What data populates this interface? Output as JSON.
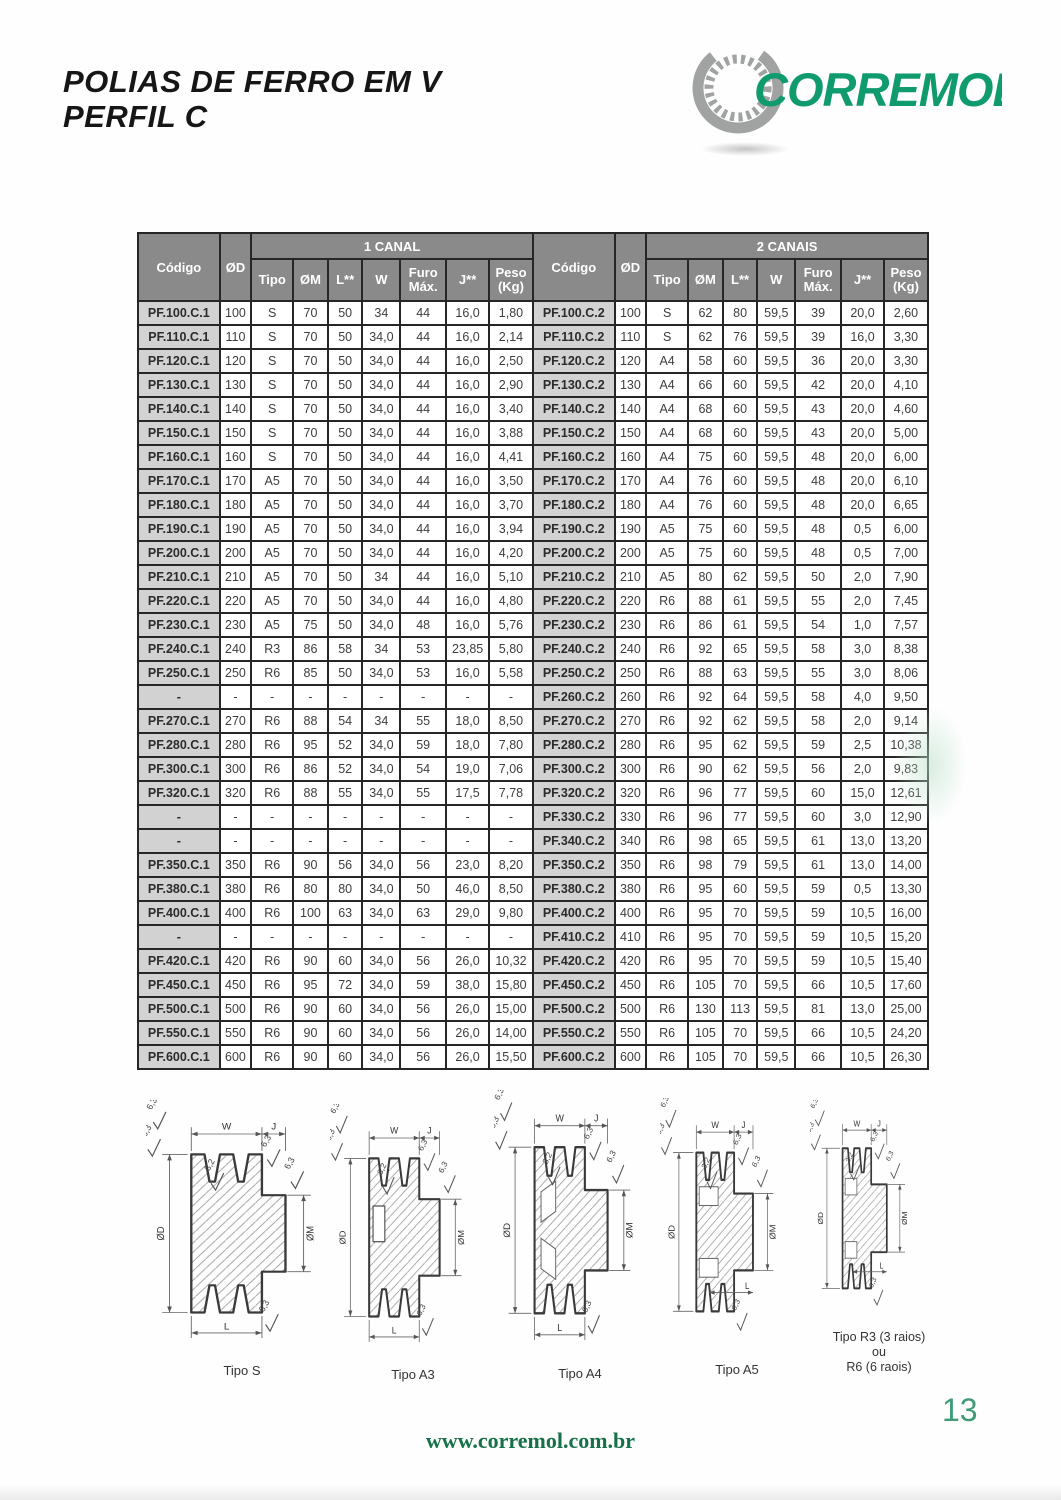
{
  "page": {
    "title_line1": "POLIAS DE FERRO EM V",
    "title_line2": "PERFIL C",
    "footer_url": "www.corremol.com.br",
    "page_number": "13"
  },
  "logo": {
    "text": "CORREMOL",
    "green": "#0f9b6d",
    "gear_gray": "#a0a3a2"
  },
  "table": {
    "header": {
      "codigo": "Código",
      "od": "ØD",
      "group1": "1 CANAL",
      "group2": "2 CANAIS",
      "sub": {
        "tipo": "Tipo",
        "om": "ØM",
        "l": "L**",
        "w": "W",
        "furo1": "Furo",
        "furo2": "Máx.",
        "j": "J**",
        "peso1": "Peso",
        "peso2": "(Kg)"
      }
    },
    "rows": [
      [
        "PF.100.C.1",
        "100",
        "S",
        "70",
        "50",
        "34",
        "44",
        "16,0",
        "1,80",
        "PF.100.C.2",
        "100",
        "S",
        "62",
        "80",
        "59,5",
        "39",
        "20,0",
        "2,60"
      ],
      [
        "PF.110.C.1",
        "110",
        "S",
        "70",
        "50",
        "34,0",
        "44",
        "16,0",
        "2,14",
        "PF.110.C.2",
        "110",
        "S",
        "62",
        "76",
        "59,5",
        "39",
        "16,0",
        "3,30"
      ],
      [
        "PF.120.C.1",
        "120",
        "S",
        "70",
        "50",
        "34,0",
        "44",
        "16,0",
        "2,50",
        "PF.120.C.2",
        "120",
        "A4",
        "58",
        "60",
        "59,5",
        "36",
        "20,0",
        "3,30"
      ],
      [
        "PF.130.C.1",
        "130",
        "S",
        "70",
        "50",
        "34,0",
        "44",
        "16,0",
        "2,90",
        "PF.130.C.2",
        "130",
        "A4",
        "66",
        "60",
        "59,5",
        "42",
        "20,0",
        "4,10"
      ],
      [
        "PF.140.C.1",
        "140",
        "S",
        "70",
        "50",
        "34,0",
        "44",
        "16,0",
        "3,40",
        "PF.140.C.2",
        "140",
        "A4",
        "68",
        "60",
        "59,5",
        "43",
        "20,0",
        "4,60"
      ],
      [
        "PF.150.C.1",
        "150",
        "S",
        "70",
        "50",
        "34,0",
        "44",
        "16,0",
        "3,88",
        "PF.150.C.2",
        "150",
        "A4",
        "68",
        "60",
        "59,5",
        "43",
        "20,0",
        "5,00"
      ],
      [
        "PF.160.C.1",
        "160",
        "S",
        "70",
        "50",
        "34,0",
        "44",
        "16,0",
        "4,41",
        "PF.160.C.2",
        "160",
        "A4",
        "75",
        "60",
        "59,5",
        "48",
        "20,0",
        "6,00"
      ],
      [
        "PF.170.C.1",
        "170",
        "A5",
        "70",
        "50",
        "34,0",
        "44",
        "16,0",
        "3,50",
        "PF.170.C.2",
        "170",
        "A4",
        "76",
        "60",
        "59,5",
        "48",
        "20,0",
        "6,10"
      ],
      [
        "PF.180.C.1",
        "180",
        "A5",
        "70",
        "50",
        "34,0",
        "44",
        "16,0",
        "3,70",
        "PF.180.C.2",
        "180",
        "A4",
        "76",
        "60",
        "59,5",
        "48",
        "20,0",
        "6,65"
      ],
      [
        "PF.190.C.1",
        "190",
        "A5",
        "70",
        "50",
        "34,0",
        "44",
        "16,0",
        "3,94",
        "PF.190.C.2",
        "190",
        "A5",
        "75",
        "60",
        "59,5",
        "48",
        "0,5",
        "6,00"
      ],
      [
        "PF.200.C.1",
        "200",
        "A5",
        "70",
        "50",
        "34,0",
        "44",
        "16,0",
        "4,20",
        "PF.200.C.2",
        "200",
        "A5",
        "75",
        "60",
        "59,5",
        "48",
        "0,5",
        "7,00"
      ],
      [
        "PF.210.C.1",
        "210",
        "A5",
        "70",
        "50",
        "34",
        "44",
        "16,0",
        "5,10",
        "PF.210.C.2",
        "210",
        "A5",
        "80",
        "62",
        "59,5",
        "50",
        "2,0",
        "7,90"
      ],
      [
        "PF.220.C.1",
        "220",
        "A5",
        "70",
        "50",
        "34,0",
        "44",
        "16,0",
        "4,80",
        "PF.220.C.2",
        "220",
        "R6",
        "88",
        "61",
        "59,5",
        "55",
        "2,0",
        "7,45"
      ],
      [
        "PF.230.C.1",
        "230",
        "A5",
        "75",
        "50",
        "34,0",
        "48",
        "16,0",
        "5,76",
        "PF.230.C.2",
        "230",
        "R6",
        "86",
        "61",
        "59,5",
        "54",
        "1,0",
        "7,57"
      ],
      [
        "PF.240.C.1",
        "240",
        "R3",
        "86",
        "58",
        "34",
        "53",
        "23,85",
        "5,80",
        "PF.240.C.2",
        "240",
        "R6",
        "92",
        "65",
        "59,5",
        "58",
        "3,0",
        "8,38"
      ],
      [
        "PF.250.C.1",
        "250",
        "R6",
        "85",
        "50",
        "34,0",
        "53",
        "16,0",
        "5,58",
        "PF.250.C.2",
        "250",
        "R6",
        "88",
        "63",
        "59,5",
        "55",
        "3,0",
        "8,06"
      ],
      [
        "-",
        "-",
        "-",
        "-",
        "-",
        "-",
        "-",
        "-",
        "-",
        "PF.260.C.2",
        "260",
        "R6",
        "92",
        "64",
        "59,5",
        "58",
        "4,0",
        "9,50"
      ],
      [
        "PF.270.C.1",
        "270",
        "R6",
        "88",
        "54",
        "34",
        "55",
        "18,0",
        "8,50",
        "PF.270.C.2",
        "270",
        "R6",
        "92",
        "62",
        "59,5",
        "58",
        "2,0",
        "9,14"
      ],
      [
        "PF.280.C.1",
        "280",
        "R6",
        "95",
        "52",
        "34,0",
        "59",
        "18,0",
        "7,80",
        "PF.280.C.2",
        "280",
        "R6",
        "95",
        "62",
        "59,5",
        "59",
        "2,5",
        "10,38"
      ],
      [
        "PF.300.C.1",
        "300",
        "R6",
        "86",
        "52",
        "34,0",
        "54",
        "19,0",
        "7,06",
        "PF.300.C.2",
        "300",
        "R6",
        "90",
        "62",
        "59,5",
        "56",
        "2,0",
        "9,83"
      ],
      [
        "PF.320.C.1",
        "320",
        "R6",
        "88",
        "55",
        "34,0",
        "55",
        "17,5",
        "7,78",
        "PF.320.C.2",
        "320",
        "R6",
        "96",
        "77",
        "59,5",
        "60",
        "15,0",
        "12,61"
      ],
      [
        "-",
        "-",
        "-",
        "-",
        "-",
        "-",
        "-",
        "-",
        "-",
        "PF.330.C.2",
        "330",
        "R6",
        "96",
        "77",
        "59,5",
        "60",
        "3,0",
        "12,90"
      ],
      [
        "-",
        "-",
        "-",
        "-",
        "-",
        "-",
        "-",
        "-",
        "-",
        "PF.340.C.2",
        "340",
        "R6",
        "98",
        "65",
        "59,5",
        "61",
        "13,0",
        "13,20"
      ],
      [
        "PF.350.C.1",
        "350",
        "R6",
        "90",
        "56",
        "34,0",
        "56",
        "23,0",
        "8,20",
        "PF.350.C.2",
        "350",
        "R6",
        "98",
        "79",
        "59,5",
        "61",
        "13,0",
        "14,00"
      ],
      [
        "PF.380.C.1",
        "380",
        "R6",
        "80",
        "80",
        "34,0",
        "50",
        "46,0",
        "8,50",
        "PF.380.C.2",
        "380",
        "R6",
        "95",
        "60",
        "59,5",
        "59",
        "0,5",
        "13,30"
      ],
      [
        "PF.400.C.1",
        "400",
        "R6",
        "100",
        "63",
        "34,0",
        "63",
        "29,0",
        "9,80",
        "PF.400.C.2",
        "400",
        "R6",
        "95",
        "70",
        "59,5",
        "59",
        "10,5",
        "16,00"
      ],
      [
        "-",
        "-",
        "-",
        "-",
        "-",
        "-",
        "-",
        "-",
        "-",
        "PF.410.C.2",
        "410",
        "R6",
        "95",
        "70",
        "59,5",
        "59",
        "10,5",
        "15,20"
      ],
      [
        "PF.420.C.1",
        "420",
        "R6",
        "90",
        "60",
        "34,0",
        "56",
        "26,0",
        "10,32",
        "PF.420.C.2",
        "420",
        "R6",
        "95",
        "70",
        "59,5",
        "59",
        "10,5",
        "15,40"
      ],
      [
        "PF.450.C.1",
        "450",
        "R6",
        "95",
        "72",
        "34,0",
        "59",
        "38,0",
        "15,80",
        "PF.450.C.2",
        "450",
        "R6",
        "105",
        "70",
        "59,5",
        "66",
        "10,5",
        "17,60"
      ],
      [
        "PF.500.C.1",
        "500",
        "R6",
        "90",
        "60",
        "34,0",
        "56",
        "26,0",
        "15,00",
        "PF.500.C.2",
        "500",
        "R6",
        "130",
        "113",
        "59,5",
        "81",
        "13,0",
        "25,00"
      ],
      [
        "PF.550.C.1",
        "550",
        "R6",
        "90",
        "60",
        "34,0",
        "56",
        "26,0",
        "14,00",
        "PF.550.C.2",
        "550",
        "R6",
        "105",
        "70",
        "59,5",
        "66",
        "10,5",
        "24,20"
      ],
      [
        "PF.600.C.1",
        "600",
        "R6",
        "90",
        "60",
        "34,0",
        "56",
        "26,0",
        "15,50",
        "PF.600.C.2",
        "600",
        "R6",
        "105",
        "70",
        "59,5",
        "66",
        "10,5",
        "26,30"
      ]
    ]
  },
  "diagrams": {
    "labels": {
      "w": "W",
      "j": "J",
      "od": "ØD",
      "om": "ØM",
      "l": "L",
      "f63": "6,3",
      "f32": "3,2"
    },
    "captions": [
      "Tipo S",
      "Tipo A3",
      "Tipo A4",
      "Tipo A5"
    ],
    "caption_r_lines": [
      "Tipo R3 (3 raios)",
      "ou",
      "R6 (6 raois)"
    ]
  }
}
